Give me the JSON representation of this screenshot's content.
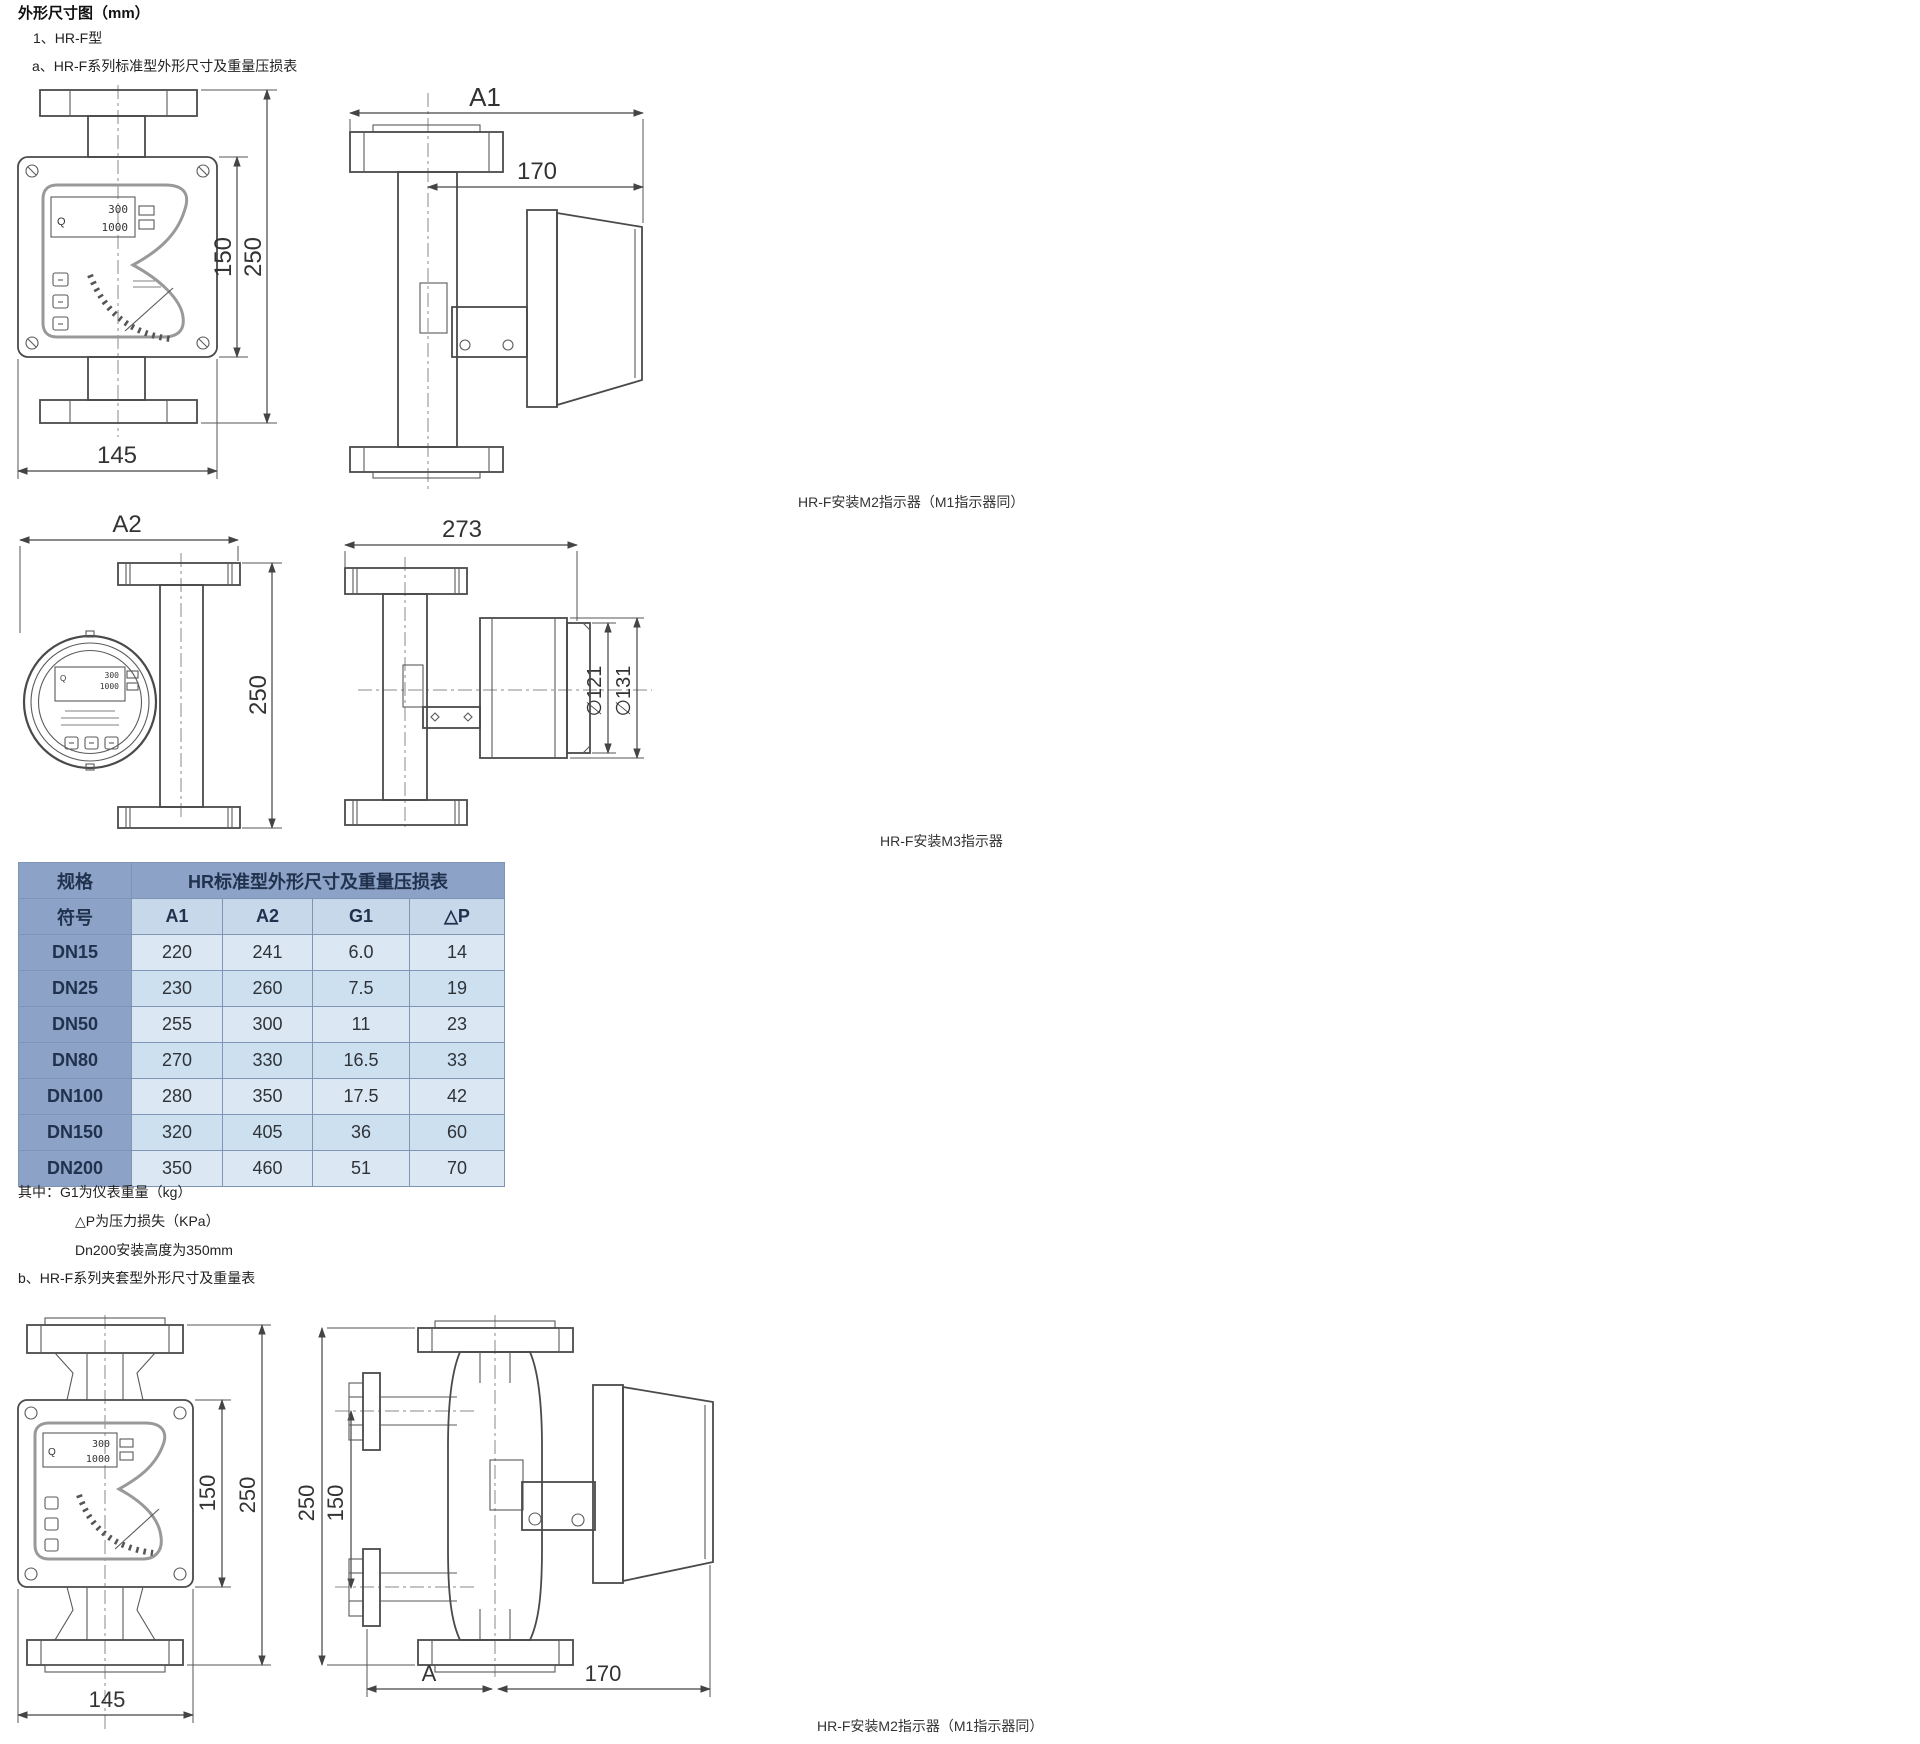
{
  "page": {
    "title": "外形尺寸图（mm）",
    "item1": "1、HR-F型",
    "item_a": "a、HR-F系列标准型外形尺寸及重量压损表",
    "item_b": "b、HR-F系列夹套型外形尺寸及重量表",
    "caption_top": "HR-F安装M2指示器（M1指示器同）",
    "caption_mid": "HR-F安装M3指示器",
    "caption_bottom": "HR-F安装M2指示器（M1指示器同）"
  },
  "notes": {
    "line1": "其中：G1为仪表重量（kg）",
    "line2": "△P为压力损失（KPa）",
    "line3": "Dn200安装高度为350mm"
  },
  "table": {
    "col_spec": "规格",
    "col_group": "HR标准型外形尺寸及重量压损表",
    "symbol": "符号",
    "headers": [
      "A1",
      "A2",
      "G1",
      "△P"
    ],
    "rows": [
      [
        "DN15",
        "220",
        "241",
        "6.0",
        "14"
      ],
      [
        "DN25",
        "230",
        "260",
        "7.5",
        "19"
      ],
      [
        "DN50",
        "255",
        "300",
        "11",
        "23"
      ],
      [
        "DN80",
        "270",
        "330",
        "16.5",
        "33"
      ],
      [
        "DN100",
        "280",
        "350",
        "17.5",
        "42"
      ],
      [
        "DN150",
        "320",
        "405",
        "36",
        "60"
      ],
      [
        "DN200",
        "350",
        "460",
        "51",
        "70"
      ]
    ]
  },
  "dims": {
    "d145": "145",
    "d150": "150",
    "d250": "250",
    "a1": "A1",
    "d170": "170",
    "a2": "A2",
    "d273": "273",
    "d121": "∅121",
    "d131": "∅131",
    "a": "A"
  },
  "display": {
    "q": "Q",
    "line1": "300",
    "line2": "1000"
  },
  "colors": {
    "table_header_bg": "#8ca2c6",
    "table_symbol_bg": "#c7d8ea",
    "table_row_light": "#dbe8f4",
    "table_row_alt": "#cde0ef",
    "table_border": "#7f95b5",
    "line_color": "#4a4a4a"
  }
}
